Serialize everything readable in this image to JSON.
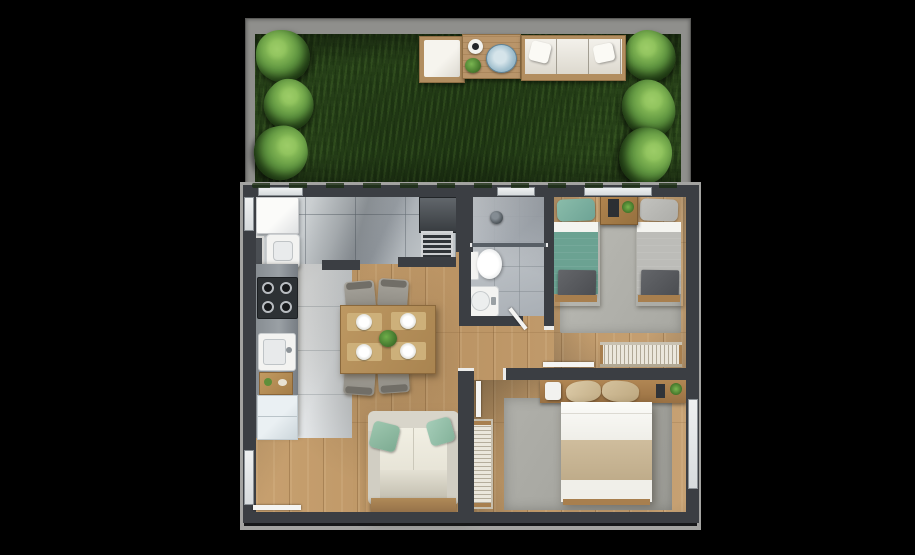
{
  "scene": {
    "type": "3d-floor-plan-top-view",
    "sections": [
      "garden",
      "apartment"
    ]
  },
  "garden": {
    "elements": [
      "grass-lawn",
      "bush-row-left",
      "bush-row-right",
      "patio-deck"
    ],
    "bush_count_left": 3,
    "bush_count_right": 3,
    "patio_items": [
      "lounge-chair",
      "coffee-table",
      "cup",
      "blue-platter",
      "potted-plant",
      "outdoor-sofa",
      "throw-pillows"
    ]
  },
  "apartment": {
    "rooms": [
      {
        "id": "service-laundry",
        "items": [
          "washing-machine",
          "laundry-cabinet",
          "laundry-tank",
          "refrigerator",
          "vent-grille"
        ]
      },
      {
        "id": "kitchen",
        "items": [
          "counter",
          "cooktop",
          "kitchen-sink",
          "cutting-board",
          "base-cabinet"
        ]
      },
      {
        "id": "living-dining",
        "items": [
          "dining-table",
          "dining-chairs",
          "plates",
          "table-plant",
          "sofa",
          "sofa-pillows",
          "entrance-door"
        ]
      },
      {
        "id": "bathroom",
        "items": [
          "shower-area",
          "floor-drain",
          "shower-screen",
          "toilet",
          "washbasin",
          "door"
        ]
      },
      {
        "id": "bedroom-twin",
        "items": [
          "single-bed-teal",
          "single-bed-gray",
          "nightstand",
          "tablet",
          "plant",
          "foot-blankets",
          "rug",
          "wardrobe",
          "door"
        ]
      },
      {
        "id": "bedroom-master",
        "items": [
          "double-bed",
          "headboard",
          "pillows",
          "lamp",
          "plant",
          "rug",
          "wardrobe",
          "door"
        ]
      },
      {
        "id": "hallway",
        "items": []
      }
    ],
    "counts": {
      "windows": 6,
      "door_leaves": 4,
      "cooktop_burners": 4,
      "dining_chairs": 4,
      "plates": 4,
      "beds": 3,
      "wardrobes": 2,
      "rugs": 3,
      "sofa_pillows": 2
    }
  },
  "colors": {
    "bg": "#000000",
    "garden_wall": "#8f8f8c",
    "grass": "#2f4c1e",
    "bush": "#5f9540",
    "deck_wood": "#b28e60",
    "patio_cushion": "#dcd9d0",
    "tray_blue": "#9fbecd",
    "wall": "#3b3e43",
    "wall_trim": "#a3a3a1",
    "window": "#eef0f1",
    "tile_service": "#c0c5c8",
    "tile_bath": "#b9bec3",
    "floor_wood": "#c29c6c",
    "floor_white": "#e3e6e8",
    "counter": "#9aa0a5",
    "stove": "#2d3134",
    "fixture": "#f3f3f1",
    "rug": "#a8a8a2",
    "bed_teal": "#6ba292",
    "bed_gray": "#bcbcb8",
    "bench": "#4b4d51",
    "furniture_wood": "#a87f4e",
    "wardrobe": "#ebe7dc",
    "sofa": "#e7e4d7",
    "pillow_teal": "#7dab92",
    "blanket": "#bfac8a",
    "plant": "#4e8a33",
    "chair_gray": "#8f8c84"
  }
}
